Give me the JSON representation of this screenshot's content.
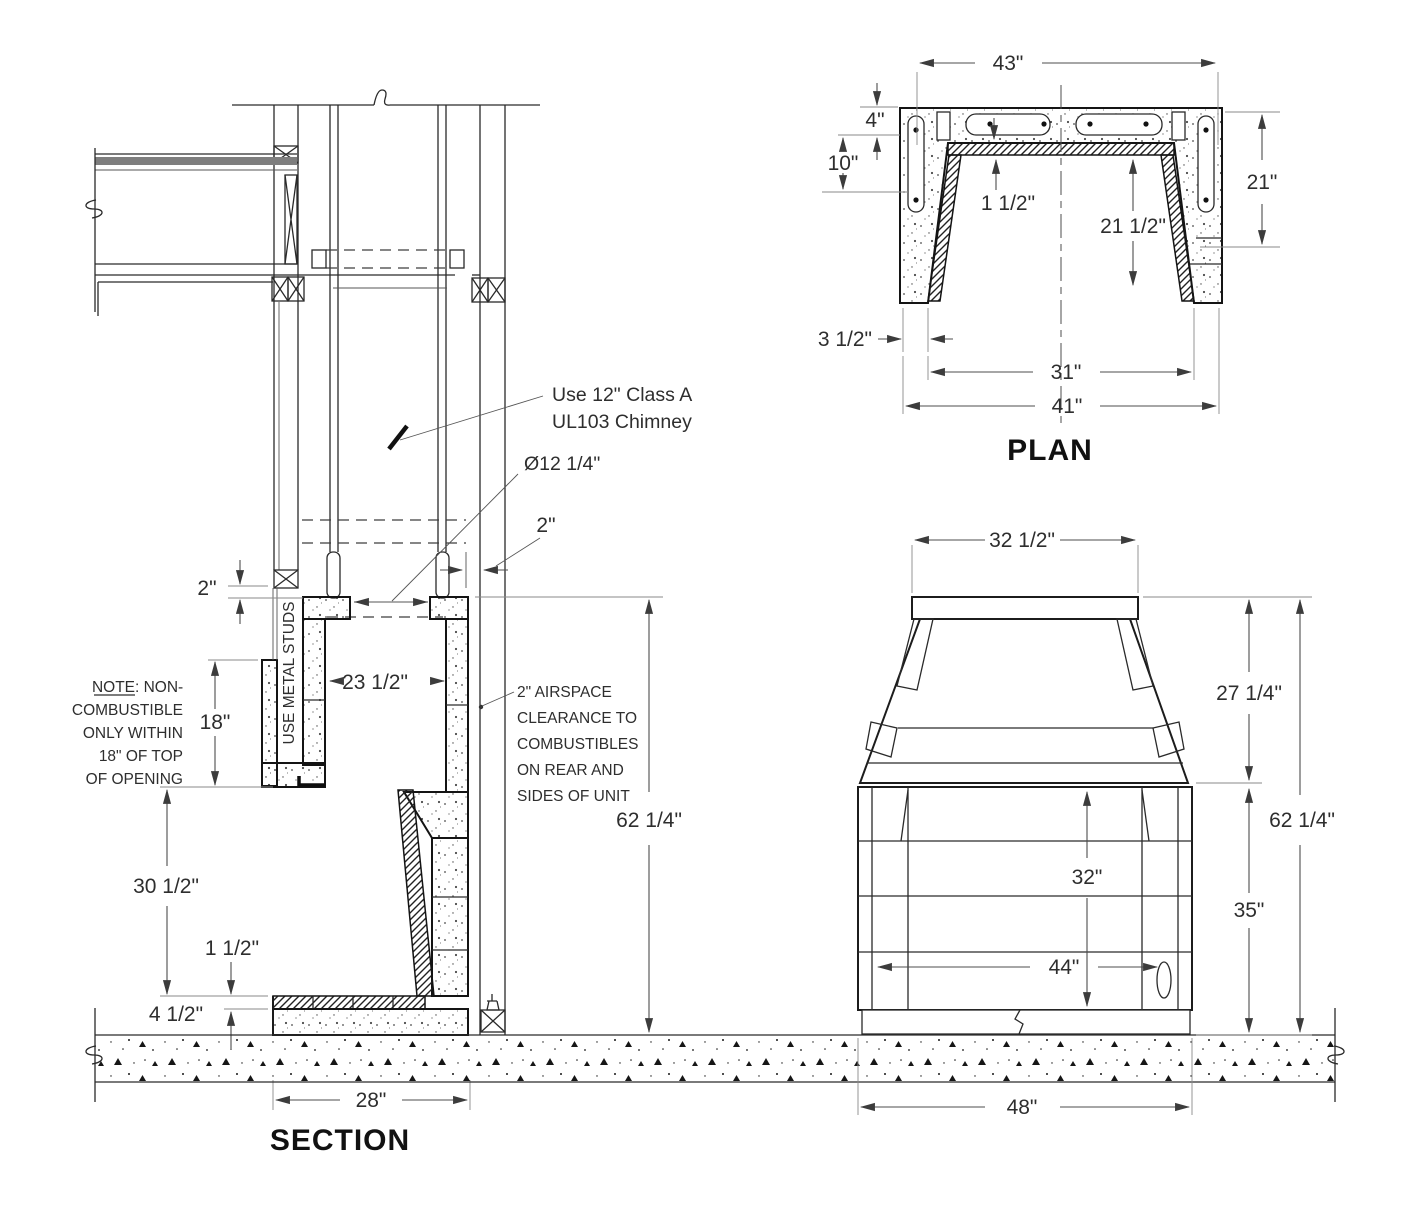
{
  "section": {
    "title": "SECTION",
    "notes": {
      "chimney_line1": "Use 12\" Class A",
      "chimney_line2": "UL103 Chimney",
      "metal_studs": "USE METAL STUDS",
      "noncomb_word": "NOTE",
      "noncomb_line1_rest": ": NON-",
      "noncomb_line2": "COMBUSTIBLE",
      "noncomb_line3": "ONLY WITHIN",
      "noncomb_line4": "18\" OF TOP",
      "noncomb_line5": "OF OPENING",
      "airspace_line1": "2\" AIRSPACE",
      "airspace_line2": "CLEARANCE TO",
      "airspace_line3": "COMBUSTIBLES",
      "airspace_line4": "ON REAR AND",
      "airspace_line5": "SIDES OF UNIT"
    },
    "dims": {
      "flue_diameter": "Ø12 1/4\"",
      "airspace_gap": "2\"",
      "top_gap": "2\"",
      "noncomb_height": "18\"",
      "chase_inner_width": "23 1/2\"",
      "opening_height": "30 1/2\"",
      "firebrick_thickness": "1 1/2\"",
      "hearth_pad_height": "4 1/2\"",
      "unit_depth": "28\"",
      "overall_height": "62 1/4\""
    }
  },
  "plan": {
    "title": "PLAN",
    "dims": {
      "overall_top_width": "43\"",
      "rear_wall_thickness": "4\"",
      "side_wall_depth": "10\"",
      "side_length": "21\"",
      "liner_thickness": "1 1/2\"",
      "inner_depth": "21 1/2\"",
      "front_wall_thickness": "3 1/2\"",
      "inner_front_width": "31\"",
      "outer_front_width": "41\""
    }
  },
  "elevation": {
    "dims": {
      "top_width": "32 1/2\"",
      "hood_height": "27 1/4\"",
      "overall_height": "62 1/4\"",
      "opening_height": "32\"",
      "base_height": "35\"",
      "opening_width": "44\"",
      "overall_width": "48\""
    }
  }
}
